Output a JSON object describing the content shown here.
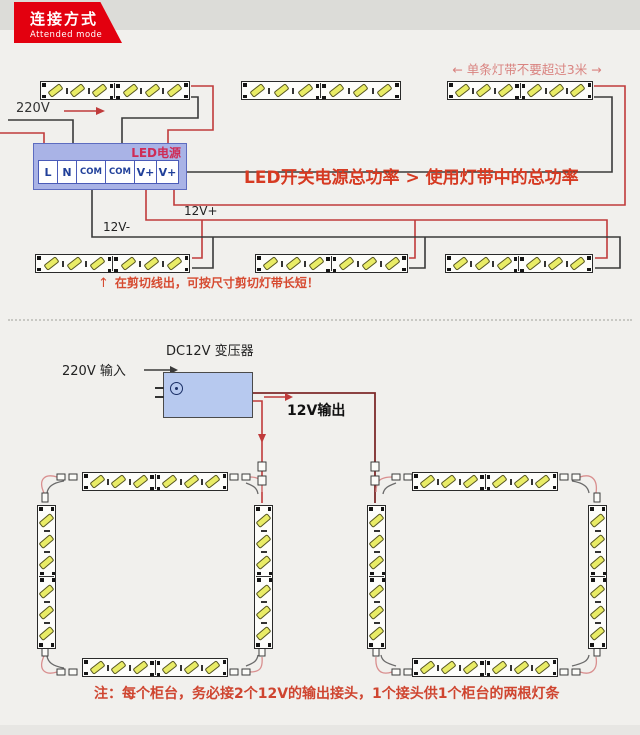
{
  "banner": {
    "title": "连接方式",
    "subtitle": "Attended mode"
  },
  "top": {
    "length_note": "← 单条灯带不要超过3米 →",
    "mains_label": "220V",
    "psu_title": "LED电源",
    "terminals": [
      "L",
      "N",
      "COM",
      "COM",
      "V+",
      "V+"
    ],
    "power_rule": "LED开关电源总功率 > 使用灯带中的总功率",
    "bus_plus": "12V+",
    "bus_minus": "12V-",
    "cut_arrow": "↑",
    "cut_note": "在剪切线出，可按尺寸剪切灯带长短！"
  },
  "bottom": {
    "transformer_title": "DC12V 变压器",
    "input_label": "220V 输入",
    "output_label": "12V输出",
    "note": "注：每个柜台，务必接2个12V的输出接头，1个接头供1个柜台的两根灯条"
  },
  "colors": {
    "accent_red": "#e3000f",
    "wire_red": "#c03b3b",
    "wire_dark_red": "#7d2a2a",
    "wire_black": "#3a3a3a",
    "wire_salmon": "#d98f8f",
    "chip_yellow": "#e9ec66",
    "psu_fill": "#a9b3e6",
    "transformer_fill": "#b7c9ef",
    "text_red": "#d63a22"
  },
  "diagram": {
    "chips_per_segment": 3,
    "strips": [
      {
        "id": "row1-1",
        "x": 40,
        "y": 81,
        "len": 150,
        "orient": "h"
      },
      {
        "id": "row1-2",
        "x": 241,
        "y": 81,
        "len": 160,
        "orient": "h"
      },
      {
        "id": "row1-3",
        "x": 447,
        "y": 81,
        "len": 146,
        "orient": "h"
      },
      {
        "id": "row2-1",
        "x": 35,
        "y": 254,
        "len": 155,
        "orient": "h"
      },
      {
        "id": "row2-2",
        "x": 255,
        "y": 254,
        "len": 153,
        "orient": "h"
      },
      {
        "id": "row2-3",
        "x": 445,
        "y": 254,
        "len": 148,
        "orient": "h"
      },
      {
        "id": "loop-left-top",
        "x": 82,
        "y": 472,
        "len": 146,
        "orient": "h"
      },
      {
        "id": "loop-left-bottom",
        "x": 82,
        "y": 658,
        "len": 146,
        "orient": "h"
      },
      {
        "id": "loop-left-left",
        "x": 37,
        "y": 505,
        "len": 144,
        "orient": "v"
      },
      {
        "id": "loop-left-right",
        "x": 254,
        "y": 505,
        "len": 144,
        "orient": "v"
      },
      {
        "id": "loop-right-top",
        "x": 412,
        "y": 472,
        "len": 146,
        "orient": "h"
      },
      {
        "id": "loop-right-bottom",
        "x": 412,
        "y": 658,
        "len": 146,
        "orient": "h"
      },
      {
        "id": "loop-right-left",
        "x": 367,
        "y": 505,
        "len": 144,
        "orient": "v"
      },
      {
        "id": "loop-right-right",
        "x": 588,
        "y": 505,
        "len": 144,
        "orient": "v"
      }
    ]
  }
}
